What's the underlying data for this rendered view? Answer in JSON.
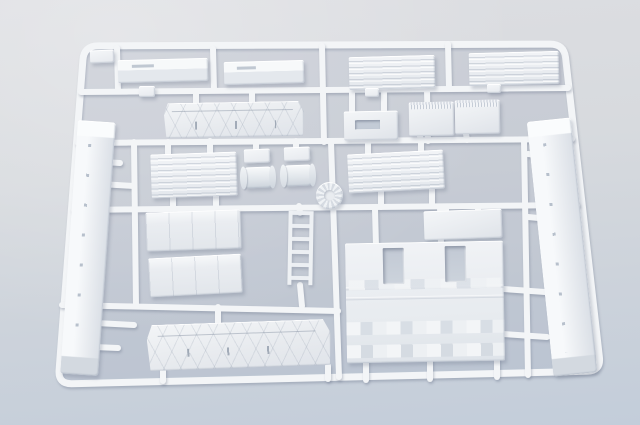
{
  "scene": {
    "subject": "plastic-model-kit-sprue-white-parts",
    "palette": {
      "background_top": "#dddee2",
      "background_bottom": "#c3cdda",
      "plastic_base": "#eaedf1",
      "plastic_highlight": "#f8fafb",
      "plastic_shadow": "#c9ced6",
      "runner": "#f3f5f7",
      "interior_tint": "rgba(152,166,188,0.14)",
      "shadow": "rgba(108,118,140,0.38)"
    },
    "frame": {
      "path": "M 98 45.9 L 550 44.1 Q 564 44 565.6 57.9 L 599.4 357.1 Q 601 371 587 371.3 L 72 383.7 Q 58 384 59.1 370 L 82.9 60 Q 84 46 98 45.9 Z",
      "stroke_width": 7
    },
    "runners": [
      {
        "x1": 81,
        "y1": 92,
        "x2": 568,
        "y2": 88
      },
      {
        "x1": 78,
        "y1": 143,
        "x2": 572,
        "y2": 139
      },
      {
        "x1": 74,
        "y1": 210,
        "x2": 577,
        "y2": 205
      },
      {
        "x1": 62,
        "y1": 305,
        "x2": 338,
        "y2": 311
      },
      {
        "x1": 117,
        "y1": 48,
        "x2": 118,
        "y2": 91
      },
      {
        "x1": 213,
        "y1": 49,
        "x2": 214,
        "y2": 90
      },
      {
        "x1": 322,
        "y1": 46,
        "x2": 324,
        "y2": 142
      },
      {
        "x1": 448,
        "y1": 44,
        "x2": 449,
        "y2": 89
      },
      {
        "x1": 427,
        "y1": 90,
        "x2": 428,
        "y2": 141
      },
      {
        "x1": 331,
        "y1": 142,
        "x2": 339,
        "y2": 377
      },
      {
        "x1": 134,
        "y1": 142,
        "x2": 136,
        "y2": 306
      },
      {
        "x1": 524,
        "y1": 141,
        "x2": 528,
        "y2": 375
      },
      {
        "x1": 375,
        "y1": 209,
        "x2": 376,
        "y2": 246
      },
      {
        "x1": 440,
        "y1": 207,
        "x2": 441,
        "y2": 244
      },
      {
        "x1": 366,
        "y1": 360,
        "x2": 366,
        "y2": 380
      },
      {
        "x1": 430,
        "y1": 359,
        "x2": 430,
        "y2": 379
      },
      {
        "x1": 497,
        "y1": 357,
        "x2": 497,
        "y2": 377
      },
      {
        "x1": 218,
        "y1": 307,
        "x2": 218,
        "y2": 325
      },
      {
        "x1": 300,
        "y1": 285,
        "x2": 302,
        "y2": 306
      },
      {
        "x1": 299,
        "y1": 206,
        "x2": 300,
        "y2": 213
      },
      {
        "x1": 328,
        "y1": 366,
        "x2": 328,
        "y2": 379
      },
      {
        "x1": 163,
        "y1": 368,
        "x2": 163,
        "y2": 381
      },
      {
        "x1": 104,
        "y1": 162,
        "x2": 120,
        "y2": 163
      },
      {
        "x1": 100,
        "y1": 184,
        "x2": 134,
        "y2": 186
      },
      {
        "x1": 96,
        "y1": 323,
        "x2": 134,
        "y2": 325
      },
      {
        "x1": 94,
        "y1": 347,
        "x2": 118,
        "y2": 348
      },
      {
        "x1": 528,
        "y1": 154,
        "x2": 547,
        "y2": 156
      },
      {
        "x1": 528,
        "y1": 217,
        "x2": 549,
        "y2": 219
      },
      {
        "x1": 503,
        "y1": 289,
        "x2": 545,
        "y2": 292
      },
      {
        "x1": 503,
        "y1": 334,
        "x2": 547,
        "y2": 337
      },
      {
        "x1": 168,
        "y1": 142,
        "x2": 168,
        "y2": 156
      },
      {
        "x1": 210,
        "y1": 141,
        "x2": 210,
        "y2": 155
      },
      {
        "x1": 173,
        "y1": 197,
        "x2": 173,
        "y2": 209
      },
      {
        "x1": 216,
        "y1": 196,
        "x2": 216,
        "y2": 208
      },
      {
        "x1": 368,
        "y1": 143,
        "x2": 368,
        "y2": 157
      },
      {
        "x1": 421,
        "y1": 141,
        "x2": 421,
        "y2": 155
      },
      {
        "x1": 381,
        "y1": 190,
        "x2": 381,
        "y2": 207
      },
      {
        "x1": 432,
        "y1": 188,
        "x2": 432,
        "y2": 205
      },
      {
        "x1": 420,
        "y1": 136,
        "x2": 421,
        "y2": 142
      },
      {
        "x1": 466,
        "y1": 134,
        "x2": 467,
        "y2": 140
      },
      {
        "x1": 256,
        "y1": 142,
        "x2": 256,
        "y2": 150
      },
      {
        "x1": 296,
        "y1": 141,
        "x2": 296,
        "y2": 149
      },
      {
        "x1": 196,
        "y1": 92,
        "x2": 196,
        "y2": 104
      },
      {
        "x1": 252,
        "y1": 91,
        "x2": 252,
        "y2": 103
      },
      {
        "x1": 352,
        "y1": 91,
        "x2": 352,
        "y2": 113
      },
      {
        "x1": 384,
        "y1": 90,
        "x2": 384,
        "y2": 112
      },
      {
        "x1": 446,
        "y1": 208,
        "x2": 446,
        "y2": 214
      },
      {
        "x1": 478,
        "y1": 207,
        "x2": 478,
        "y2": 213
      }
    ],
    "parts": [
      {
        "name": "corner-tab",
        "type": "tab",
        "x": 90,
        "y": 50,
        "w": 24,
        "h": 13,
        "rot": -2
      },
      {
        "name": "flat-strip-a",
        "type": "strip",
        "x": 118,
        "y": 59,
        "w": 90,
        "h": 23,
        "rot": -1.5
      },
      {
        "name": "flat-strip-b",
        "type": "strip",
        "x": 224,
        "y": 61,
        "w": 80,
        "h": 23,
        "rot": -1.5
      },
      {
        "name": "vent-deck-a",
        "type": "louver",
        "x": 349,
        "y": 56,
        "w": 86,
        "h": 33,
        "rot": -1.5
      },
      {
        "name": "vent-deck-b",
        "type": "louver",
        "x": 469,
        "y": 52,
        "w": 90,
        "h": 33,
        "rot": -1.5
      },
      {
        "name": "truss-panel-a",
        "type": "truss",
        "x": 164,
        "y": 102,
        "w": 140,
        "h": 35,
        "rot": -1
      },
      {
        "name": "recess-plate",
        "type": "recess",
        "x": 344,
        "y": 111,
        "w": 54,
        "h": 29,
        "rot": -1
      },
      {
        "name": "ribbed-box-a",
        "type": "ribtop",
        "x": 409,
        "y": 102,
        "w": 45,
        "h": 34,
        "rot": -1
      },
      {
        "name": "ribbed-box-b",
        "type": "ribtop",
        "x": 455,
        "y": 100,
        "w": 45,
        "h": 34,
        "rot": -1
      },
      {
        "name": "hull-rail-left",
        "type": "rail",
        "x": 69,
        "y": 121,
        "w": 38,
        "h": 254,
        "rot": 4
      },
      {
        "name": "louver-box",
        "type": "louver",
        "x": 151,
        "y": 153,
        "w": 86,
        "h": 44,
        "rot": -2
      },
      {
        "name": "tee-fitting-a",
        "type": "tab",
        "x": 244,
        "y": 149,
        "w": 26,
        "h": 14,
        "rot": -2
      },
      {
        "name": "tee-fitting-b",
        "type": "tab",
        "x": 284,
        "y": 147,
        "w": 26,
        "h": 14,
        "rot": -2
      },
      {
        "name": "roller-drum-a",
        "type": "drum",
        "x": 242,
        "y": 167,
        "w": 32,
        "h": 21,
        "rot": -2
      },
      {
        "name": "roller-drum-b",
        "type": "drum",
        "x": 282,
        "y": 165,
        "w": 32,
        "h": 21,
        "rot": -2
      },
      {
        "name": "idler-wheel",
        "type": "disc",
        "x": 316,
        "y": 182,
        "w": 27,
        "h": 27,
        "rot": 0
      },
      {
        "name": "vent-panel-long",
        "type": "louver",
        "x": 348,
        "y": 152,
        "w": 96,
        "h": 39,
        "rot": -3
      },
      {
        "name": "side-box-a",
        "type": "panelbox",
        "x": 146,
        "y": 211,
        "w": 95,
        "h": 39,
        "rot": -2
      },
      {
        "name": "side-box-b",
        "type": "panelbox",
        "x": 149,
        "y": 256,
        "w": 93,
        "h": 39,
        "rot": -3
      },
      {
        "name": "ladder",
        "type": "ladder",
        "x": 288,
        "y": 211,
        "w": 25,
        "h": 74,
        "rot": 1
      },
      {
        "name": "roof-plate",
        "type": "plate",
        "x": 424,
        "y": 210,
        "w": 78,
        "h": 29,
        "rot": -2
      },
      {
        "name": "engine-bulkhead",
        "type": "bigpanel",
        "x": 346,
        "y": 242,
        "w": 158,
        "h": 120,
        "rot": -1
      },
      {
        "name": "window-cutout-a",
        "type": "hole",
        "x": 383,
        "y": 248,
        "w": 21,
        "h": 36,
        "rot": -1
      },
      {
        "name": "window-cutout-b",
        "type": "hole",
        "x": 445,
        "y": 246,
        "w": 21,
        "h": 36,
        "rot": -1
      },
      {
        "name": "hull-rail-right",
        "type": "rail",
        "x": 540,
        "y": 119,
        "w": 44,
        "h": 256,
        "rot": -6
      },
      {
        "name": "truss-panel-b",
        "type": "truss",
        "x": 147,
        "y": 322,
        "w": 184,
        "h": 46,
        "rot": -2
      },
      {
        "name": "mount-tab-a",
        "type": "tab",
        "x": 139,
        "y": 86,
        "w": 16,
        "h": 11,
        "rot": 0
      },
      {
        "name": "mount-tab-b",
        "type": "tab",
        "x": 365,
        "y": 88,
        "w": 14,
        "h": 9,
        "rot": 0
      },
      {
        "name": "mount-tab-c",
        "type": "tab",
        "x": 487,
        "y": 84,
        "w": 14,
        "h": 9,
        "rot": 0
      }
    ]
  }
}
